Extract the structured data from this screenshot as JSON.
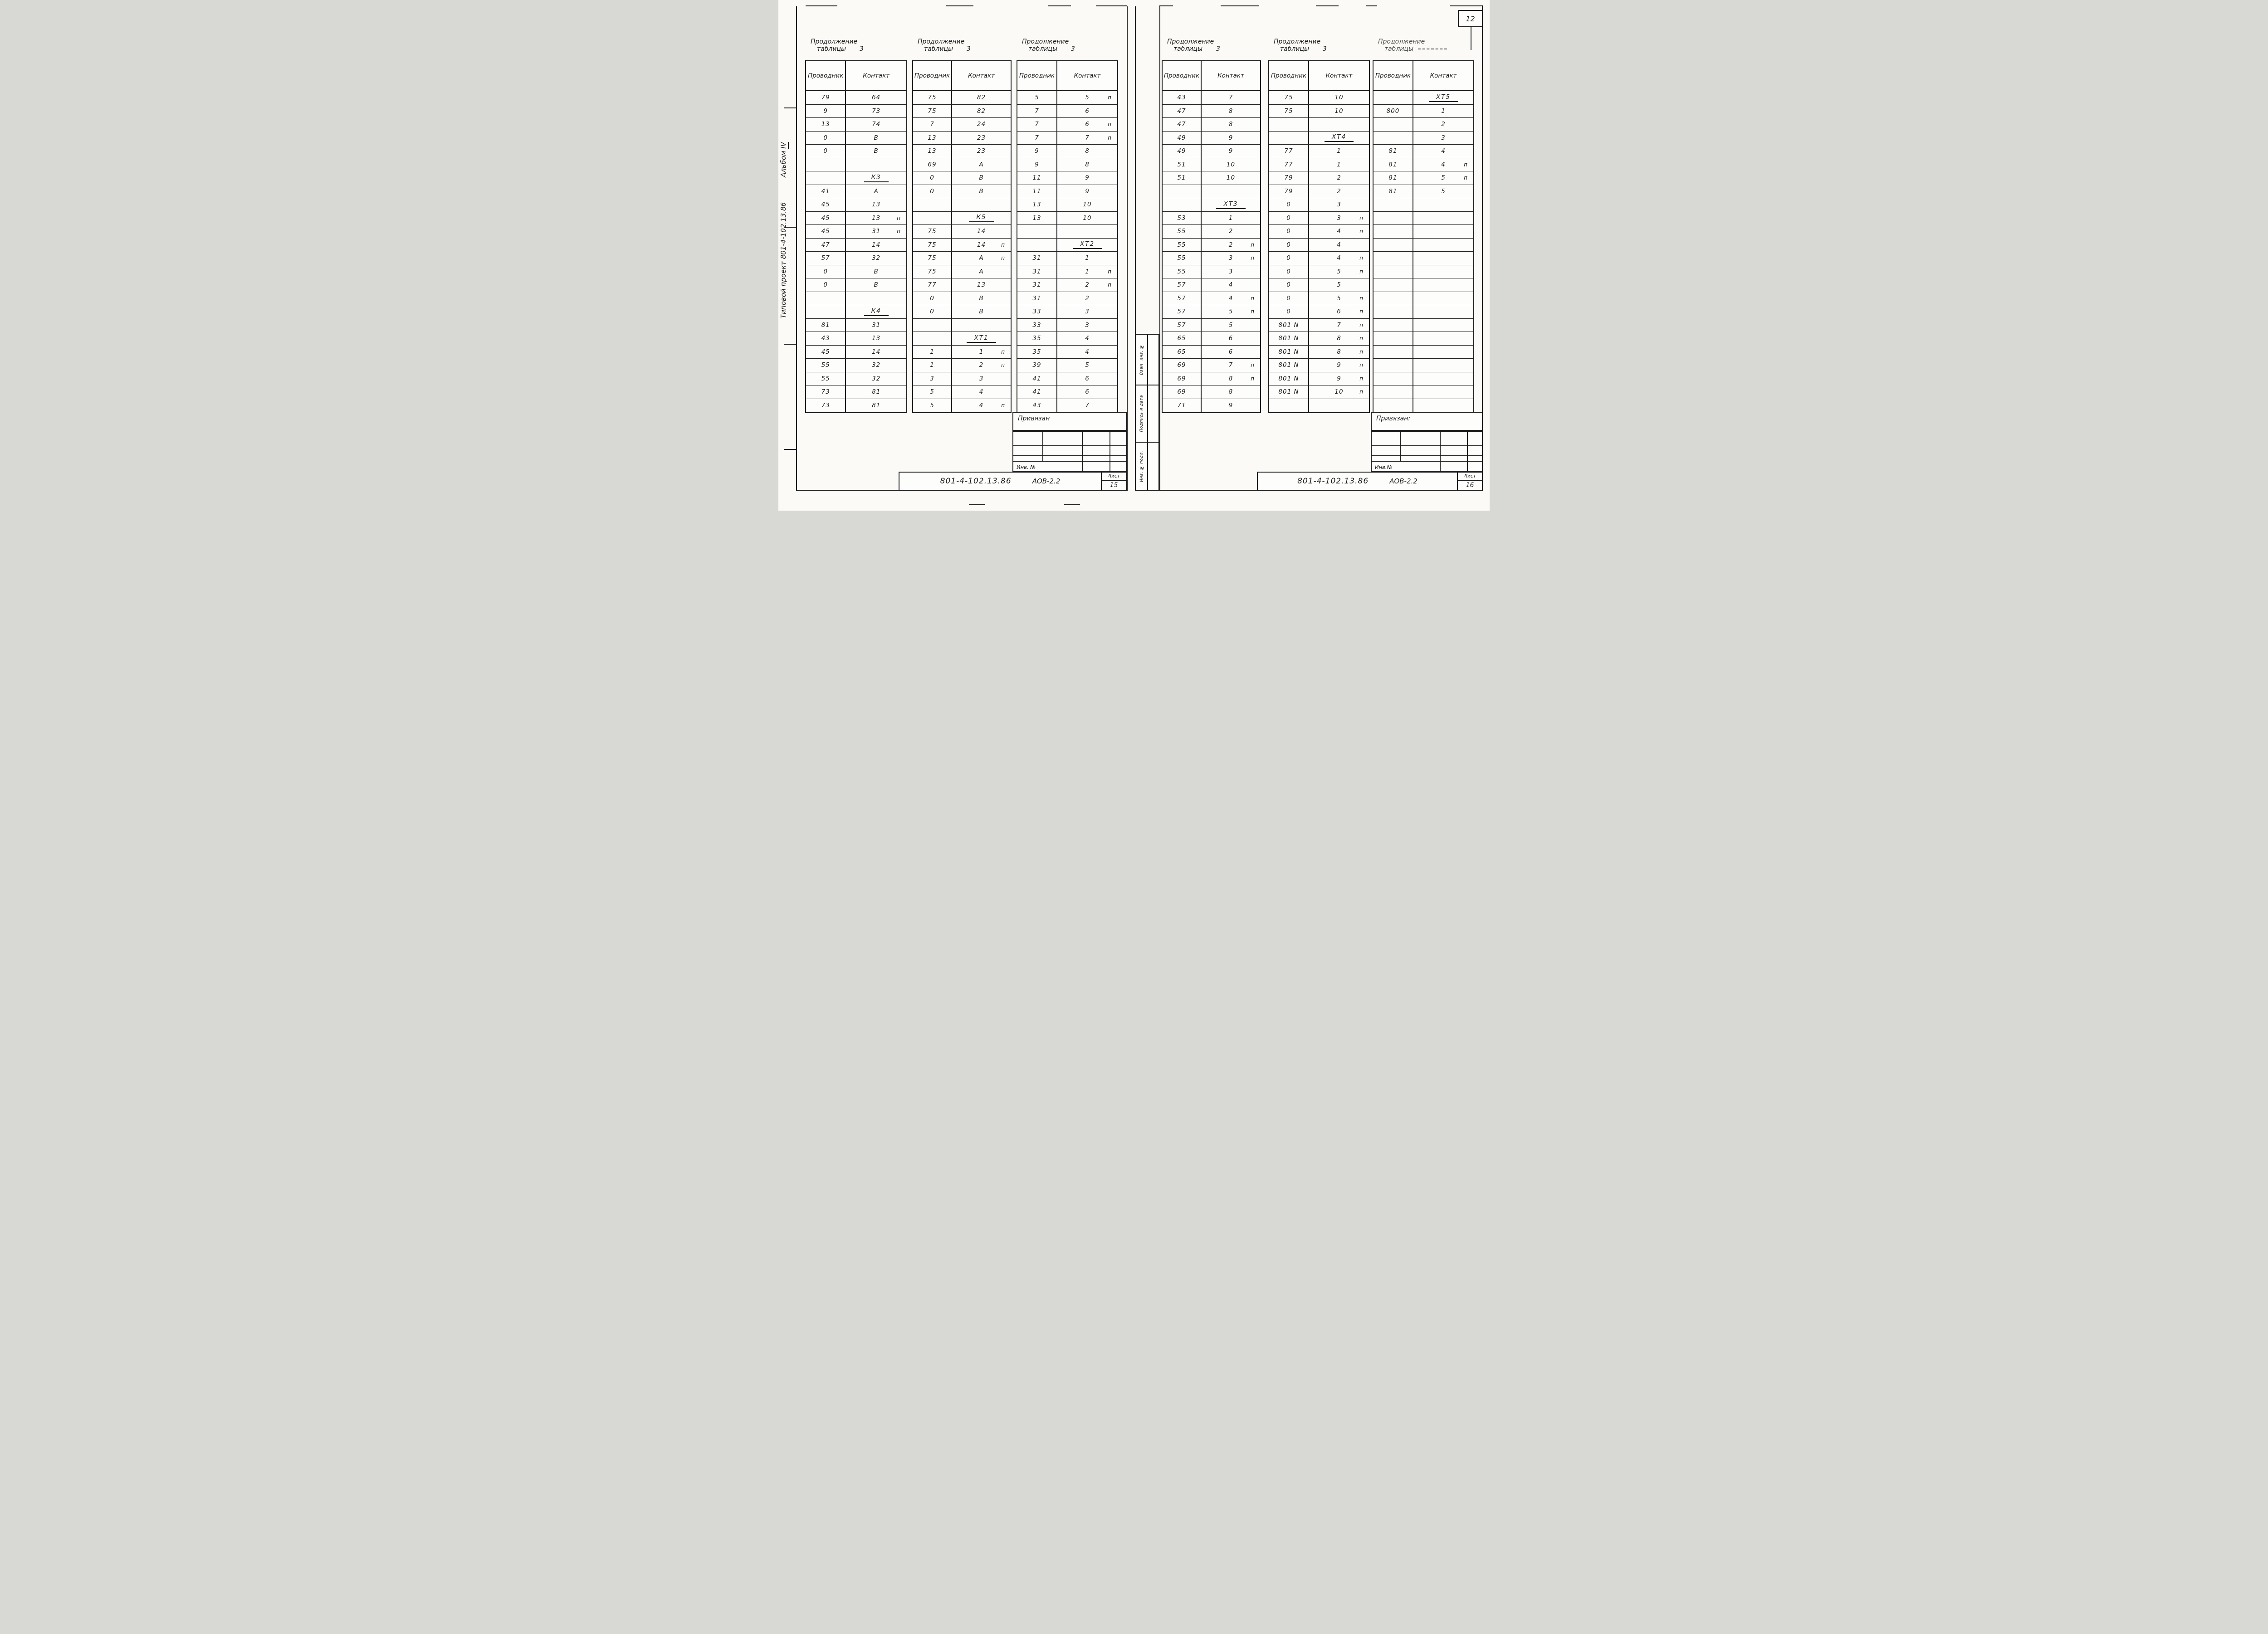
{
  "page": {
    "sheet_badge": "12"
  },
  "left_margin": {
    "text1": "Типовой проект 801-4-102.13.86",
    "text2": "Альбом",
    "text3": "IV"
  },
  "side_strip": {
    "cells": [
      "Взам. инв. №",
      "Подпись и дата",
      "Инв. № подл."
    ]
  },
  "blocks": [
    {
      "header": "Привязан",
      "inv_label": "Инв. №",
      "doc": "801-4-102.13.86",
      "code": "АОВ-2.2",
      "sheet_label": "Лист",
      "sheet_num": "15"
    },
    {
      "header": "Привязан:",
      "inv_label": "Инв.№",
      "doc": "801-4-102.13.86",
      "code": "АОВ-2.2",
      "sheet_label": "Лист",
      "sheet_num": "16"
    }
  ],
  "tables": [
    {
      "title1": "Продолжение",
      "title2": "таблицы",
      "title_num": "3",
      "faded": false,
      "col1": "Проводник",
      "col2": "Контакт",
      "rows": [
        [
          "79",
          "64",
          ""
        ],
        [
          "9",
          "73",
          ""
        ],
        [
          "13",
          "74",
          ""
        ],
        [
          "0",
          "В",
          ""
        ],
        [
          "0",
          "В",
          ""
        ],
        [
          "",
          "",
          ""
        ],
        [
          "",
          "К3",
          "g"
        ],
        [
          "41",
          "А",
          ""
        ],
        [
          "45",
          "13",
          ""
        ],
        [
          "45",
          "13",
          "п"
        ],
        [
          "45",
          "31",
          "п"
        ],
        [
          "47",
          "14",
          ""
        ],
        [
          "57",
          "32",
          ""
        ],
        [
          "0",
          "В",
          ""
        ],
        [
          "0",
          "В",
          ""
        ],
        [
          "",
          "",
          ""
        ],
        [
          "",
          "К4",
          "g"
        ],
        [
          "81",
          "31",
          ""
        ],
        [
          "43",
          "13",
          ""
        ],
        [
          "45",
          "14",
          ""
        ],
        [
          "55",
          "32",
          ""
        ],
        [
          "55",
          "32",
          ""
        ],
        [
          "73",
          "81",
          ""
        ],
        [
          "73",
          "81",
          ""
        ]
      ]
    },
    {
      "title1": "Продолжение",
      "title2": "таблицы",
      "title_num": "3",
      "faded": false,
      "col1": "Проводник",
      "col2": "Контакт",
      "rows": [
        [
          "75",
          "82",
          ""
        ],
        [
          "75",
          "82",
          ""
        ],
        [
          "7",
          "24",
          ""
        ],
        [
          "13",
          "23",
          ""
        ],
        [
          "13",
          "23",
          ""
        ],
        [
          "69",
          "А",
          ""
        ],
        [
          "0",
          "В",
          ""
        ],
        [
          "0",
          "В",
          ""
        ],
        [
          "",
          "",
          ""
        ],
        [
          "",
          "К5",
          "g"
        ],
        [
          "75",
          "14",
          ""
        ],
        [
          "75",
          "14",
          "п"
        ],
        [
          "75",
          "А",
          "п"
        ],
        [
          "75",
          "А",
          ""
        ],
        [
          "77",
          "13",
          ""
        ],
        [
          "0",
          "В",
          ""
        ],
        [
          "0",
          "В",
          ""
        ],
        [
          "",
          "",
          ""
        ],
        [
          "",
          "ХТ1",
          "g"
        ],
        [
          "1",
          "1",
          "п"
        ],
        [
          "1",
          "2",
          "п"
        ],
        [
          "3",
          "3",
          ""
        ],
        [
          "5",
          "4",
          ""
        ],
        [
          "5",
          "4",
          "п"
        ]
      ]
    },
    {
      "title1": "Продолжение",
      "title2": "таблицы",
      "title_num": "3",
      "faded": false,
      "col1": "Проводник",
      "col2": "Контакт",
      "rows": [
        [
          "5",
          "5",
          "п"
        ],
        [
          "7",
          "6",
          ""
        ],
        [
          "7",
          "6",
          "п"
        ],
        [
          "7",
          "7",
          "п"
        ],
        [
          "9",
          "8",
          ""
        ],
        [
          "9",
          "8",
          ""
        ],
        [
          "11",
          "9",
          ""
        ],
        [
          "11",
          "9",
          ""
        ],
        [
          "13",
          "10",
          ""
        ],
        [
          "13",
          "10",
          ""
        ],
        [
          "",
          "",
          ""
        ],
        [
          "",
          "ХТ2",
          "g"
        ],
        [
          "31",
          "1",
          ""
        ],
        [
          "31",
          "1",
          "п"
        ],
        [
          "31",
          "2",
          "п"
        ],
        [
          "31",
          "2",
          ""
        ],
        [
          "33",
          "3",
          ""
        ],
        [
          "33",
          "3",
          ""
        ],
        [
          "35",
          "4",
          ""
        ],
        [
          "35",
          "4",
          ""
        ],
        [
          "39",
          "5",
          ""
        ],
        [
          "41",
          "6",
          ""
        ],
        [
          "41",
          "6",
          ""
        ],
        [
          "43",
          "7",
          ""
        ]
      ]
    },
    {
      "title1": "Продолжение",
      "title2": "таблицы",
      "title_num": "3",
      "faded": false,
      "col1": "Проводник",
      "col2": "Контакт",
      "rows": [
        [
          "43",
          "7",
          ""
        ],
        [
          "47",
          "8",
          ""
        ],
        [
          "47",
          "8",
          ""
        ],
        [
          "49",
          "9",
          ""
        ],
        [
          "49",
          "9",
          ""
        ],
        [
          "51",
          "10",
          ""
        ],
        [
          "51",
          "10",
          ""
        ],
        [
          "",
          "",
          ""
        ],
        [
          "",
          "ХТ3",
          "g"
        ],
        [
          "53",
          "1",
          ""
        ],
        [
          "55",
          "2",
          ""
        ],
        [
          "55",
          "2",
          "п"
        ],
        [
          "55",
          "3",
          "п"
        ],
        [
          "55",
          "3",
          ""
        ],
        [
          "57",
          "4",
          ""
        ],
        [
          "57",
          "4",
          "п"
        ],
        [
          "57",
          "5",
          "п"
        ],
        [
          "57",
          "5",
          ""
        ],
        [
          "65",
          "6",
          ""
        ],
        [
          "65",
          "6",
          ""
        ],
        [
          "69",
          "7",
          "п"
        ],
        [
          "69",
          "8",
          "п"
        ],
        [
          "69",
          "8",
          ""
        ],
        [
          "71",
          "9",
          ""
        ]
      ]
    },
    {
      "title1": "Продолжение",
      "title2": "таблицы",
      "title_num": "3",
      "faded": false,
      "col1": "Проводник",
      "col2": "Контакт",
      "rows": [
        [
          "75",
          "10",
          ""
        ],
        [
          "75",
          "10",
          ""
        ],
        [
          "",
          "",
          ""
        ],
        [
          "",
          "ХТ4",
          "g"
        ],
        [
          "77",
          "1",
          ""
        ],
        [
          "77",
          "1",
          ""
        ],
        [
          "79",
          "2",
          ""
        ],
        [
          "79",
          "2",
          ""
        ],
        [
          "0",
          "3",
          ""
        ],
        [
          "0",
          "3",
          "п"
        ],
        [
          "0",
          "4",
          "п"
        ],
        [
          "0",
          "4",
          ""
        ],
        [
          "0",
          "4",
          "п"
        ],
        [
          "0",
          "5",
          "п"
        ],
        [
          "0",
          "5",
          ""
        ],
        [
          "0",
          "5",
          "п"
        ],
        [
          "0",
          "6",
          "п"
        ],
        [
          "801 N",
          "7",
          "п"
        ],
        [
          "801 N",
          "8",
          "п"
        ],
        [
          "801 N",
          "8",
          "п"
        ],
        [
          "801 N",
          "9",
          "п"
        ],
        [
          "801 N",
          "9",
          "п"
        ],
        [
          "801 N",
          "10",
          "п"
        ],
        [
          "",
          "",
          ""
        ]
      ]
    },
    {
      "title1": "Продолжение",
      "title2": "таблицы",
      "title_num": "",
      "faded": true,
      "col1": "Проводник",
      "col2": "Контакт",
      "rows": [
        [
          "",
          "ХТ5",
          "g"
        ],
        [
          "800",
          "1",
          ""
        ],
        [
          "",
          "2",
          ""
        ],
        [
          "",
          "3",
          ""
        ],
        [
          "81",
          "4",
          ""
        ],
        [
          "81",
          "4",
          "п"
        ],
        [
          "81",
          "5",
          "п"
        ],
        [
          "81",
          "5",
          ""
        ],
        [
          "",
          "",
          ""
        ],
        [
          "",
          "",
          ""
        ],
        [
          "",
          "",
          ""
        ],
        [
          "",
          "",
          ""
        ],
        [
          "",
          "",
          ""
        ],
        [
          "",
          "",
          ""
        ],
        [
          "",
          "",
          ""
        ],
        [
          "",
          "",
          ""
        ],
        [
          "",
          "",
          ""
        ],
        [
          "",
          "",
          ""
        ],
        [
          "",
          "",
          ""
        ],
        [
          "",
          "",
          ""
        ],
        [
          "",
          "",
          ""
        ],
        [
          "",
          "",
          ""
        ],
        [
          "",
          "",
          ""
        ],
        [
          "",
          "",
          ""
        ]
      ]
    }
  ]
}
